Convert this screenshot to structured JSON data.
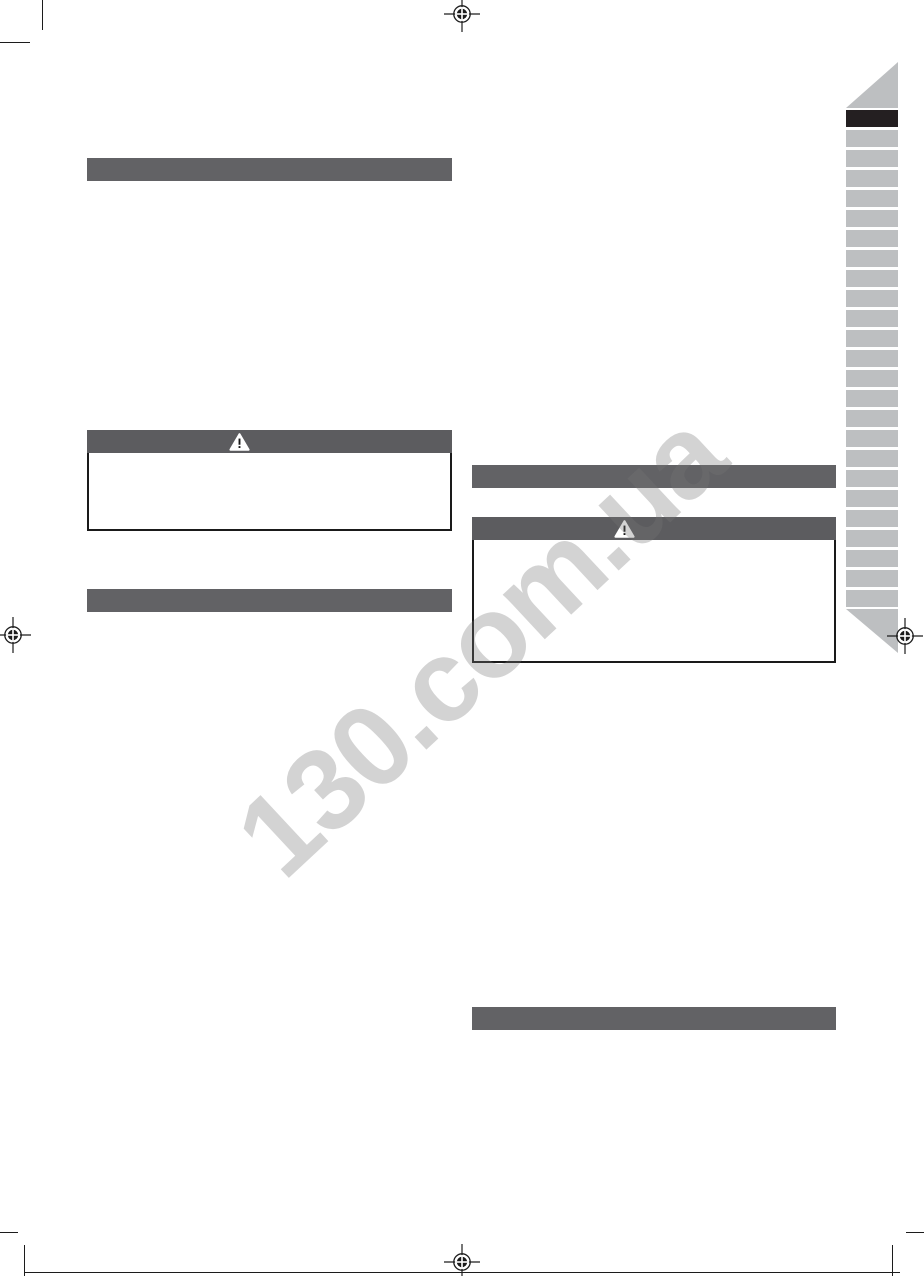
{
  "page": {
    "type": "printed-manual-page",
    "background": "#ffffff",
    "description": "print-ready manual page with blank section bars, warning boxes, language index tabs, registration and crop marks"
  },
  "watermark": {
    "text": "130.com.ua",
    "color": "#d5d5d5",
    "rotation_deg": -43
  },
  "colors": {
    "section_bar": "#626265",
    "warning_header": "#5c5c5f",
    "warning_border": "#1a1a1a",
    "sidebar_tab": "#bdbfc1",
    "sidebar_tab_selected": "#241f21",
    "mark_ink": "#1c1c1c"
  },
  "icons": {
    "warning": "warning-triangle-icon",
    "registration": "registration-mark-icon"
  },
  "left_column": {
    "section_bars": [
      {
        "label": ""
      },
      {
        "label": ""
      }
    ],
    "warning_box": {
      "title": "",
      "body": ""
    }
  },
  "right_column": {
    "section_bars": [
      {
        "label": ""
      },
      {
        "label": ""
      }
    ],
    "warning_box": {
      "title": "",
      "body": ""
    }
  },
  "sidebar": {
    "tab_count": 25,
    "selected_index": 0
  }
}
